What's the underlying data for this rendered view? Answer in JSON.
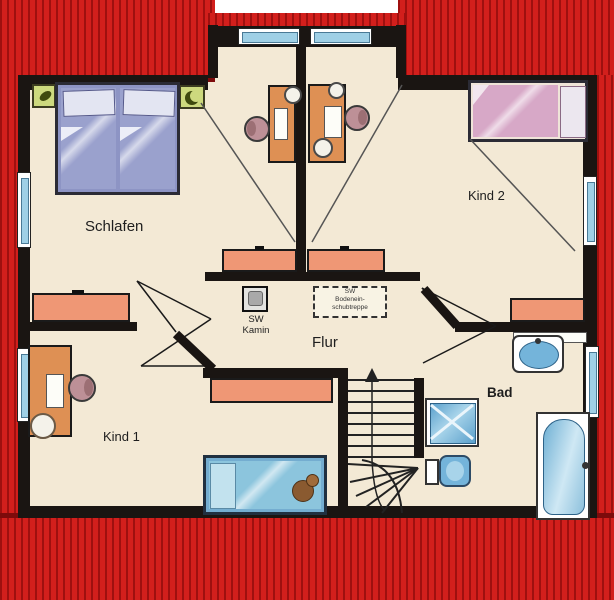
{
  "rooms": {
    "schlafen": {
      "label": "Schlafen"
    },
    "kind2": {
      "label": "Kind 2"
    },
    "kind1": {
      "label": "Kind 1"
    },
    "flur": {
      "label": "Flur"
    },
    "bad": {
      "label": "Bad"
    }
  },
  "annotations": {
    "kamin": {
      "line1": "SW",
      "line2": "Kamin"
    },
    "attic_stairs": {
      "line1": "SW",
      "line2": "Bodenein-",
      "line3": "schubtreppe"
    }
  },
  "colors": {
    "roof_red": "#d21f1c",
    "roof_stripe": "#9e100f",
    "roof_dark": "#7d0b0b",
    "wall": "#1a1512",
    "floor": "#f3e9d5",
    "salmon": "#ef9775",
    "desk_orange": "#de9054",
    "glass": "#9fd0e6",
    "bed_blue": "#9aa1cd",
    "bed_pink": "#d7a8c7",
    "bed_teal": "#8cc5dd",
    "fixture_blue": "#74b4da",
    "nightstand_green": "#cdd97e"
  }
}
